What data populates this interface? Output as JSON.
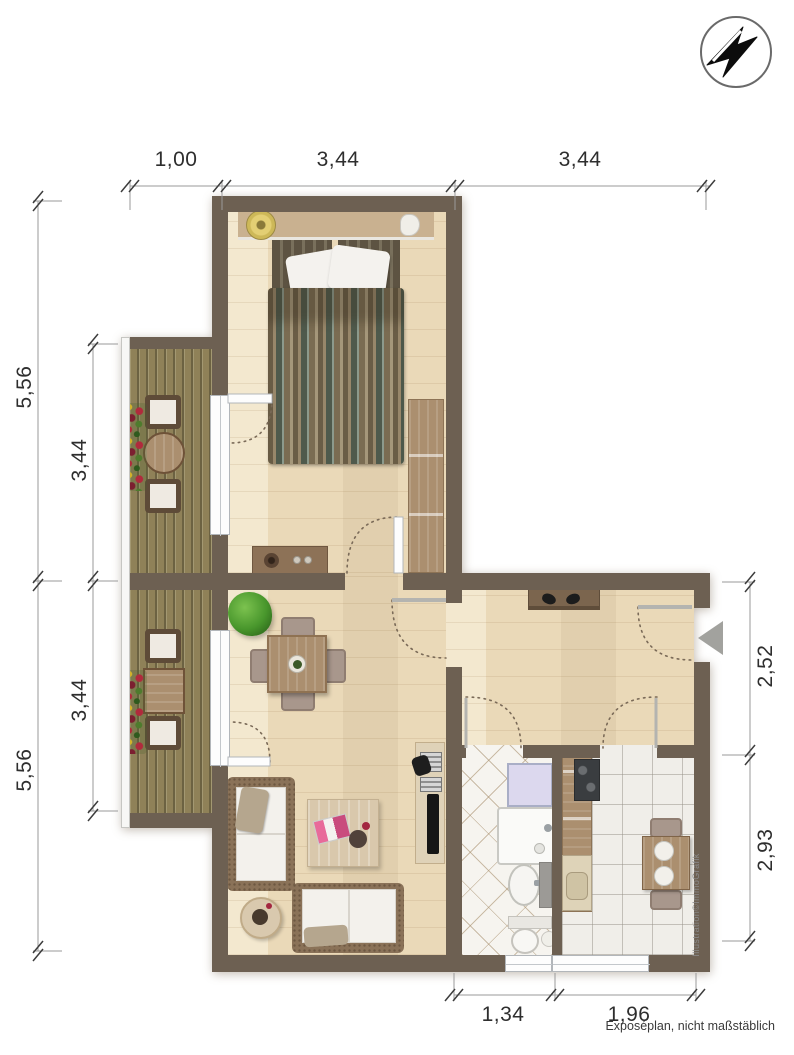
{
  "plan": {
    "disclaimer": "Exposéplan, nicht maßstäblich",
    "credit": "Illustration©ImmoGrafik",
    "dimensions": {
      "top": [
        "1,00",
        "3,44",
        "3,44"
      ],
      "left_outer": [
        "5,56",
        "5,56"
      ],
      "left_inner": [
        "3,44",
        "3,44"
      ],
      "right": [
        "2,52",
        "2,93"
      ],
      "bottom": [
        "1,34",
        "1,96"
      ]
    },
    "colors": {
      "wall": "#6d6052",
      "parquet_floor": "#ead9b8",
      "balcony_deck": "#8c7e55",
      "bath_tile": "#f6f4ef",
      "kitchen_tile": "#f0eee9",
      "entrance_arrow": "#a2a29e"
    }
  }
}
